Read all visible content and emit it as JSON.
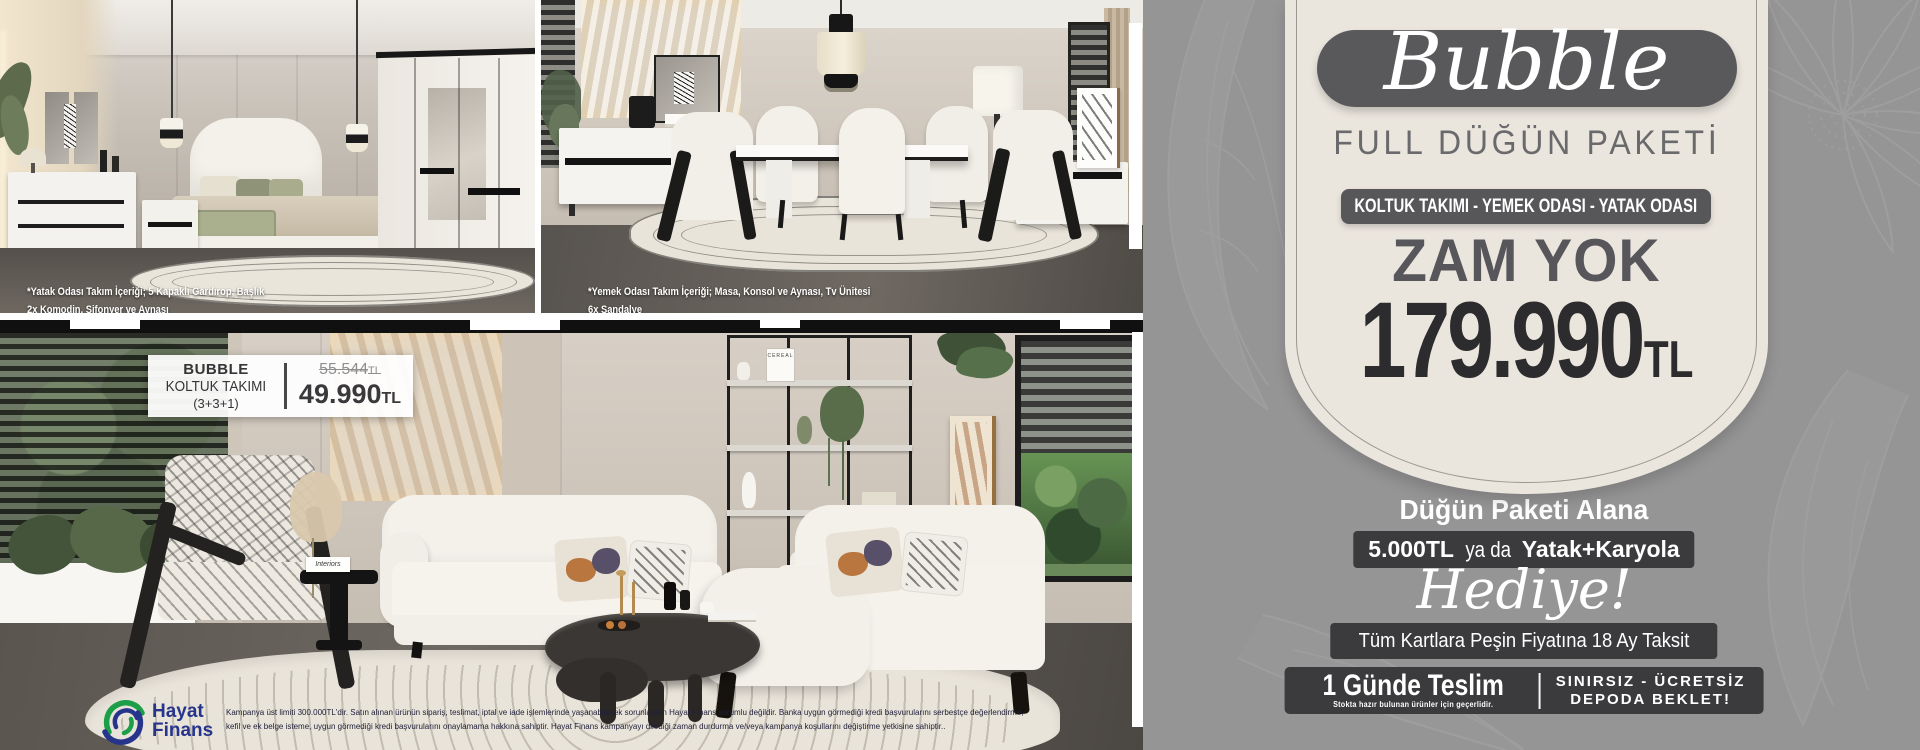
{
  "badge": {
    "brand": "Bubble",
    "subtitle": "FULL DÜĞÜN PAKETİ",
    "categories": "KOLTUK TAKIMI - YEMEK ODASI - YATAK ODASI",
    "headline": "ZAM YOK",
    "price": "179.990",
    "currency": "TL"
  },
  "offer": {
    "intro": "Düğün Paketi Alana",
    "gift_amount": "5.000TL",
    "gift_connector": "ya da",
    "gift_item": "Yatak+Karyola",
    "gift_word": "Hediye!",
    "installment": "Tüm Kartlara Peşin Fiyatına 18 Ay Taksit",
    "delivery_title": "1 Günde Teslim",
    "delivery_note": "Stokta hazır bulunan ürünler için geçerlidir.",
    "storage_line1": "SINIRSIZ - ÜCRETSİZ",
    "storage_line2": "DEPODA BEKLET!"
  },
  "captions": {
    "bedroom_line1": "*Yatak Odası Takım İçeriği; 5 Kapaklı Gardırop, Başlık",
    "bedroom_line2": "2x Komodin, Şifonyer ve Aynası",
    "dining_line1": "*Yemek Odası Takım İçeriği; Masa, Konsol ve Aynası, Tv Ünitesi",
    "dining_line2": "6x Sandalye"
  },
  "price_tag": {
    "brand": "BUBBLE",
    "product": "KOLTUK TAKIMI",
    "configuration": "(3+3+1)",
    "old_price": "55.544",
    "old_currency": "TL",
    "new_price": "49.990",
    "new_currency": "TL"
  },
  "finance": {
    "brand_top": "Hayat",
    "brand_bottom": "Finans",
    "disclaimer_line1": "Kampanya üst limiti 300.000TL'dir. Satın alınan ürünün sipariş, teslimat, iptal ve iade işlemlerinde yaşanabilecek sorunlardan Hayat Finans sorumlu değildir. Banka uygun görmediği kredi başvurularını serbestçe değerlendirme,",
    "disclaimer_line2": "kefil ve ek belge isteme, uygun görmediği kredi başvurularını onaylamama hakkına sahiptir. Hayat Finans kampanyayı dilediği zaman durdurma ve/veya kampanya koşullarını değiştirme yetkisine sahiptir.."
  },
  "decor": {
    "shelf_magazine": "CEREAL",
    "side_magazine": "Interiors"
  },
  "colors": {
    "panel_gray": "#969596",
    "cream": "#eae5dd",
    "dark_gray": "#59595b",
    "bar_dark": "#3b3b3d",
    "price_dark": "#2c2b2d",
    "finance_navy": "#27348b",
    "finance_green": "#1d9e49"
  }
}
